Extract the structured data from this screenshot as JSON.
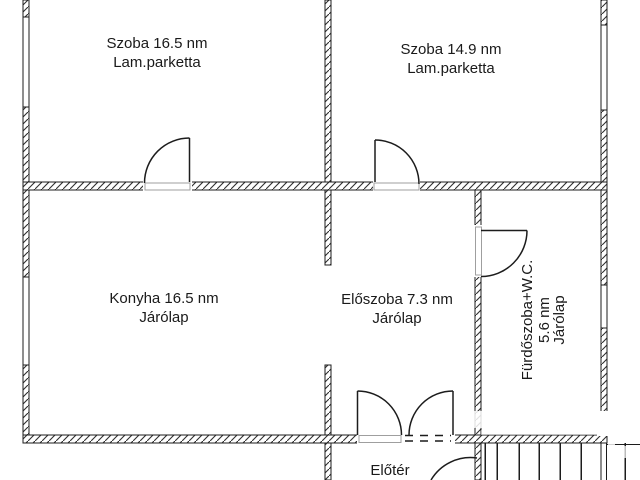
{
  "document": {
    "type": "floor-plan"
  },
  "colors": {
    "background": "#ffffff",
    "wall_line": "#1c1c1c",
    "text": "#1a1a1a",
    "jamb": "#9f9f9f"
  },
  "rooms": {
    "szoba1": {
      "line1": "Szoba 16.5 nm",
      "line2": "Lam.parketta"
    },
    "szoba2": {
      "line1": "Szoba 14.9 nm",
      "line2": "Lam.parketta"
    },
    "konyha": {
      "line1": "Konyha 16.5 nm",
      "line2": "Járólap"
    },
    "eloszoba": {
      "line1": "Előszoba 7.3 nm",
      "line2": "Járólap"
    },
    "furdoszoba": {
      "line1": "Fürdőszoba+W.C.",
      "line2": "5.6 nm",
      "line3": "Járólap"
    },
    "eloter": {
      "line1": "Előtér"
    }
  }
}
